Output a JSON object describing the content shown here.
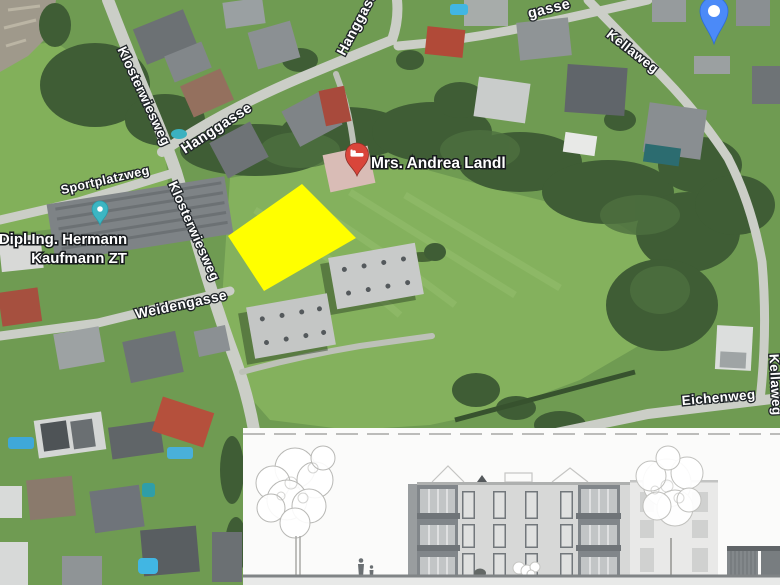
{
  "map": {
    "street_labels": {
      "klosterwiesweg_upper": "Klosterwiesweg",
      "klosterwiesweg_lower": "Klosterwiesweg",
      "hanggasse": "Hanggasse",
      "hanggasse_top": "Hanggasse",
      "gasse_partial": "gasse",
      "sportplatzweg": "Sportplatzweg",
      "weidengasse": "Weidengasse",
      "kellaweg_upper": "Kellaweg",
      "kellaweg_right": "Kellaweg",
      "eichenweg": "Eichenweg"
    },
    "pois": {
      "andrea_landl": {
        "label": "Mrs. Andrea Landl",
        "icon": "red-lodging-pin"
      },
      "kaufmann": {
        "label_line1": "Dipl.Ing. Hermann",
        "label_line2": "Kaufmann ZT",
        "icon": "teal-dot-pin"
      },
      "unlabeled_top_right": {
        "icon": "blue-map-pin"
      }
    },
    "colors": {
      "highlight_parcel": "#ffff00",
      "pin_red": "#d9453a",
      "pin_teal": "#3cb6c3",
      "pin_blue": "#4b8af8"
    }
  },
  "inset": {
    "icon": "building-elevation-drawing"
  }
}
